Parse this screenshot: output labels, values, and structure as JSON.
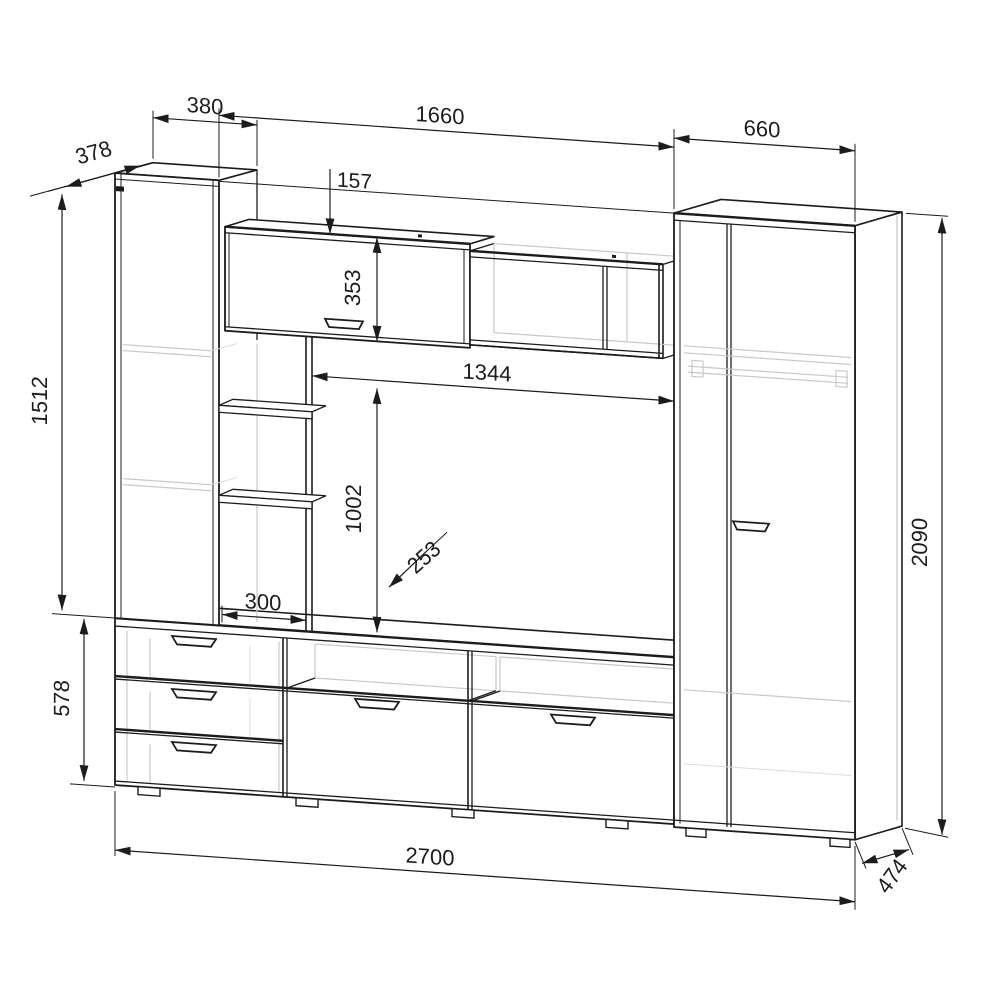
{
  "drawing": {
    "kind": "furniture-wall-unit-technical-drawing",
    "background": "#ffffff"
  },
  "colors": {
    "line": "#1c1c1c",
    "faint": "#c9c9c9",
    "background": "#ffffff"
  },
  "dimensions": {
    "left_cabinet_depth": "378",
    "left_cabinet_width": "380",
    "wall_cabinet_top_offset": "157",
    "middle_section_width": "1660",
    "wardrobe_width": "660",
    "wall_cabinet_height": "353",
    "tv_niche_width": "1344",
    "tv_niche_height": "1002",
    "shelf_depth": "253",
    "shelf_width": "300",
    "left_cabinet_height": "1512",
    "tv_stand_height": "578",
    "total_width": "2700",
    "wardrobe_height": "2090",
    "unit_depth": "474"
  }
}
